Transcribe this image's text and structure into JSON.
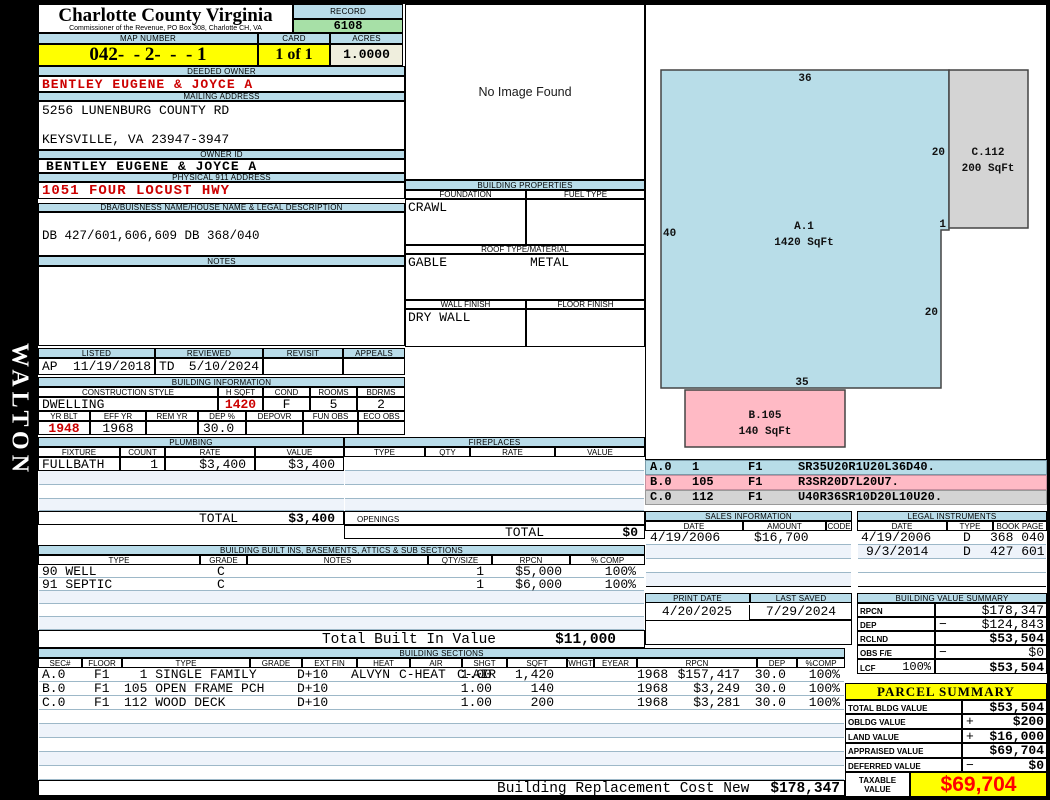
{
  "colors": {
    "band_blue": "#b9dce9",
    "stripe_blue": "#eef3fa",
    "highlight_yellow": "#ffff00",
    "record_green": "#a7e0a7",
    "acres_cream": "#efeedd",
    "alert_red": "#cc0000",
    "taxable_red": "#ff0000",
    "sketch_blue": "#b8dde8",
    "sketch_pink": "#ffbac5",
    "sketch_gray": "#d4d4d4"
  },
  "frame": {
    "side_text": "WALTON"
  },
  "header": {
    "title": "Charlotte County Virginia",
    "subtitle": "Commissioner of the Revenue, PO Box 308, Charlotte CH, VA",
    "record_label": "RECORD",
    "record_number": "6108",
    "map_label": "MAP NUMBER",
    "map_number": "042-  - 2-  -  - 1",
    "card_label": "CARD",
    "card": "1 of 1",
    "acres_label": "ACRES",
    "acres": "1.0000"
  },
  "owner": {
    "deeded_label": "DEEDED OWNER",
    "deeded_owner": "BENTLEY EUGENE & JOYCE A",
    "mailing_label": "MAILING ADDRESS",
    "address_line1": "5256 LUNENBURG COUNTY RD",
    "address_line2": "KEYSVILLE, VA 23947-3947",
    "owner_id_label": "OWNER ID",
    "owner_id": "BENTLEY EUGENE & JOYCE A",
    "physical_label": "PHYSICAL 911 ADDRESS",
    "physical_address": "1051 FOUR LOCUST HWY",
    "dba_label": "DBA/BUISNESS NAME/HOUSE NAME & LEGAL DESCRIPTION",
    "legal_description": "DB 427/601,606,609 DB 368/040",
    "notes_label": "NOTES"
  },
  "visits": {
    "listed_label": "LISTED",
    "listed_by": "AP",
    "listed_date": "11/19/2018",
    "reviewed_label": "REVIEWED",
    "reviewed_by": "TD",
    "reviewed_date": "5/10/2024",
    "revisit_label": "REVISIT",
    "appeals_label": "APPEALS"
  },
  "building_info": {
    "section_label": "BUILDING INFORMATION",
    "style_label": "CONSTRUCTION STYLE",
    "style": "DWELLING",
    "hsqft_label": "H SQFT",
    "hsqft": "1420",
    "cond_label": "COND",
    "cond": "F",
    "rooms_label": "ROOMS",
    "rooms": "5",
    "bdrms_label": "BDRMS",
    "bdrms": "2",
    "yrblt_label": "YR BLT",
    "yrblt": "1948",
    "effyr_label": "EFF YR",
    "effyr": "1968",
    "remyr_label": "REM YR",
    "dep_label": "DEP %",
    "dep": "30.0",
    "depovr_label": "DEPOVR",
    "funobs_label": "FUN OBS",
    "ecoobs_label": "ECO OBS"
  },
  "plumbing": {
    "section_label": "PLUMBING",
    "headers": [
      "FIXTURE",
      "COUNT",
      "RATE",
      "VALUE"
    ],
    "rows": [
      {
        "fixture": "FULLBATH",
        "count": "1",
        "rate": "$3,400",
        "value": "$3,400"
      }
    ],
    "total_label": "TOTAL",
    "total": "$3,400"
  },
  "fireplaces": {
    "section_label": "FIREPLACES",
    "headers": [
      "TYPE",
      "QTY",
      "RATE",
      "VALUE"
    ],
    "openings_label": "OPENINGS",
    "total_label": "TOTAL",
    "total": "$0"
  },
  "built_ins": {
    "section_label": "BUILDING BUILT INS, BASEMENTS, ATTICS & SUB SECTIONS",
    "headers": [
      "TYPE",
      "GRADE",
      "NOTES",
      "QTY/SIZE",
      "RPCN",
      "% COMP"
    ],
    "rows": [
      {
        "type": "90 WELL",
        "grade": "C",
        "qty": "1",
        "rpcn": "$5,000",
        "comp": "100%"
      },
      {
        "type": "91 SEPTIC",
        "grade": "C",
        "qty": "1",
        "rpcn": "$6,000",
        "comp": "100%"
      }
    ],
    "total_label": "Total Built In Value",
    "total": "$11,000"
  },
  "building_sections": {
    "section_label": "BUILDING SECTIONS",
    "headers": [
      "SEC#",
      "FLOOR",
      "TYPE",
      "GRADE",
      "EXT FIN",
      "HEAT",
      "AIR",
      "SHGT",
      "SQFT",
      "WHGT",
      "EYEAR",
      "RPCN",
      "DEP",
      "%COMP"
    ],
    "rows": [
      {
        "sec": "A.0",
        "floor": "F1",
        "type": "  1 SINGLE FAMILY",
        "grade": "D+10",
        "ext": "ALVYN",
        "heat": "C-HEAT",
        "air": "C-AIR",
        "shgt": "1.00",
        "sqft": "1,420",
        "eyear": "1968",
        "rpcn": "$157,417",
        "dep": "30.0",
        "comp": "100%"
      },
      {
        "sec": "B.0",
        "floor": "F1",
        "type": "105 OPEN FRAME PCH",
        "grade": "D+10",
        "ext": "",
        "heat": "",
        "air": "",
        "shgt": "1.00",
        "sqft": "140",
        "eyear": "1968",
        "rpcn": "$3,249",
        "dep": "30.0",
        "comp": "100%"
      },
      {
        "sec": "C.0",
        "floor": "F1",
        "type": "112 WOOD DECK",
        "grade": "D+10",
        "ext": "",
        "heat": "",
        "air": "",
        "shgt": "1.00",
        "sqft": "200",
        "eyear": "1968",
        "rpcn": "$3,281",
        "dep": "30.0",
        "comp": "100%"
      }
    ],
    "rcn_label": "Building Replacement Cost New",
    "rcn": "$178,347"
  },
  "photo": {
    "placeholder": "No Image Found"
  },
  "building_properties": {
    "section_label": "BUILDING PROPERTIES",
    "foundation_label": "FOUNDATION",
    "foundation": "CRAWL",
    "fuel_label": "FUEL TYPE",
    "roof_label": "ROOF TYPE/MATERIAL",
    "roof_type": "GABLE",
    "roof_material": "METAL",
    "wall_label": "WALL FINISH",
    "wall_finish": "DRY WALL",
    "floor_label": "FLOOR FINISH"
  },
  "sketch": {
    "sections": [
      {
        "id": "A.0",
        "area": "1",
        "floor": "F1",
        "vector": "SR35U20R1U20L36D40."
      },
      {
        "id": "B.0",
        "area": "105",
        "floor": "F1",
        "vector": "R3SR20D7L20U7."
      },
      {
        "id": "C.0",
        "area": "112",
        "floor": "F1",
        "vector": "U40R36SR10D20L10U20."
      }
    ],
    "shapes": {
      "a_label": "A.1",
      "a_sqft": "1420 SqFt",
      "b_label": "B.105",
      "b_sqft": "140 SqFt",
      "c_label": "C.112",
      "c_sqft": "200 SqFt"
    },
    "dims": {
      "top": "36",
      "left": "40",
      "upper_right": "20",
      "step": "1",
      "lower_right": "20",
      "bottom": "35"
    }
  },
  "sales": {
    "section_label": "SALES INFORMATION",
    "headers": [
      "DATE",
      "AMOUNT",
      "CODE"
    ],
    "rows": [
      {
        "date": "4/19/2006",
        "amount": "$16,700",
        "code": ""
      }
    ]
  },
  "legal_instruments": {
    "section_label": "LEGAL INSTRUMENTS",
    "headers": [
      "DATE",
      "TYPE",
      "BOOK PAGE"
    ],
    "rows": [
      {
        "date": "4/19/2006",
        "type": "D",
        "book_page": "368 040"
      },
      {
        "date": "9/3/2014",
        "type": "D",
        "book_page": "427 601-6"
      }
    ]
  },
  "dates": {
    "print_label": "PRINT DATE",
    "print_date": "4/20/2025",
    "saved_label": "LAST SAVED",
    "last_saved": "7/29/2024"
  },
  "value_summary": {
    "section_label": "BUILDING VALUE SUMMARY",
    "rows": [
      {
        "label": "RPCN",
        "op": "",
        "value": "$178,347"
      },
      {
        "label": "DEP",
        "op": "−",
        "value": "$124,843"
      },
      {
        "label": "RCLND",
        "op": "",
        "value": "$53,504"
      },
      {
        "label": "OBS F/E",
        "op": "−",
        "value": "$0"
      },
      {
        "label": "LCF",
        "pct": "100%",
        "op": "",
        "value": "$53,504"
      }
    ]
  },
  "parcel_summary": {
    "section_label": "PARCEL SUMMARY",
    "rows": [
      {
        "label": "TOTAL BLDG VALUE",
        "op": "",
        "value": "$53,504"
      },
      {
        "label": "OBLDG VALUE",
        "op": "+",
        "value": "$200"
      },
      {
        "label": "LAND VALUE",
        "op": "+",
        "value": "$16,000"
      },
      {
        "label": "APPRAISED VALUE",
        "op": "",
        "value": "$69,704"
      },
      {
        "label": "DEFERRED VALUE",
        "op": "−",
        "value": "$0"
      }
    ],
    "taxable_label": "TAXABLE VALUE",
    "taxable_value": "$69,704"
  }
}
